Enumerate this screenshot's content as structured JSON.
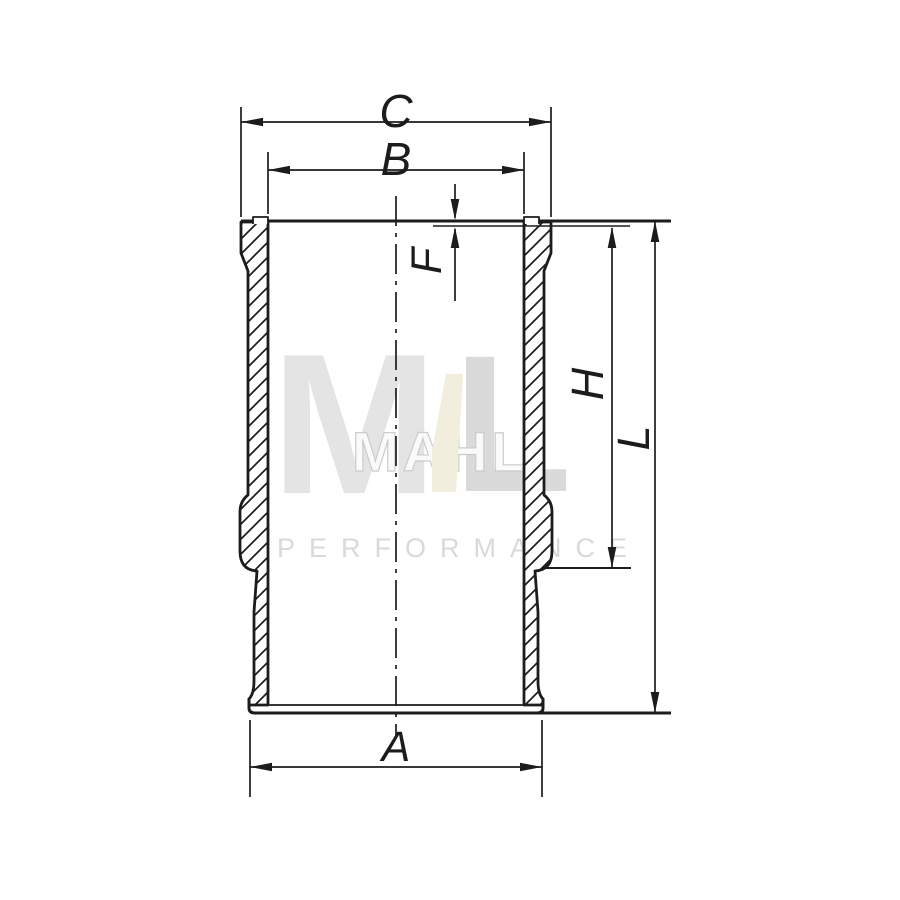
{
  "drawing": {
    "subject": "cylinder-liner-cross-section",
    "line_color": "#1c1c1c",
    "background": "#ffffff",
    "labels": {
      "c": "C",
      "b": "B",
      "f": "F",
      "h": "H",
      "l": "L",
      "a": "A"
    }
  },
  "watermark": {
    "brand": "MAHLE",
    "letter_m": "M",
    "letters_mid": "MAHL",
    "letter_l": "L",
    "subtitle": "PERFORMANCE",
    "color_gray_light": "#e4e4e4",
    "color_gray_mid": "#dadada",
    "color_outline": "#cccccc",
    "color_bolt": "#f1eedd",
    "color_subtitle": "#d9d9d9"
  }
}
